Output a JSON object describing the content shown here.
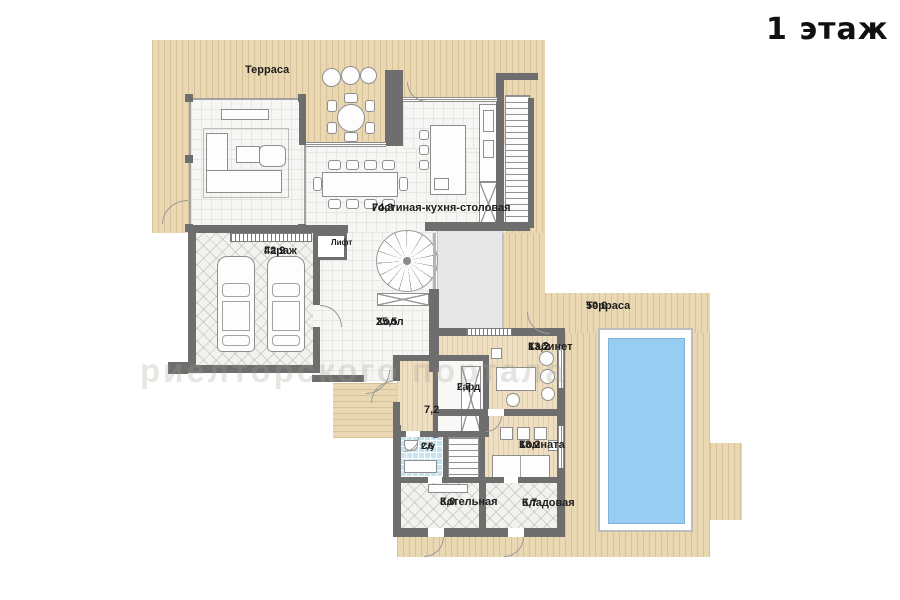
{
  "title": "1 этаж",
  "watermark": "риелторского портала",
  "colors": {
    "wall": "#6e6e6e",
    "terrace": "#ead8b3",
    "floor": "#f6f6f4",
    "wood": "#eedfc2",
    "tile": "#c5e4f0",
    "pool_water": "#98cdf2"
  },
  "rooms": {
    "terrace_top": {
      "name": "Терраса"
    },
    "living": {
      "name": "Гостиная-кухня-столовая",
      "area": "74,8"
    },
    "garage": {
      "name": "Гараж",
      "area": "42,9"
    },
    "lift": {
      "name": "Лифт"
    },
    "hall": {
      "name": "Холл",
      "area": "25,5"
    },
    "terrace_right": {
      "name": "Терраса",
      "area": "50,0"
    },
    "cabinet": {
      "name": "Кабинет",
      "area": "13,2"
    },
    "wardrobe": {
      "name": "Гард",
      "area": "2,7"
    },
    "corridor": {
      "area": "7,2"
    },
    "wc": {
      "name": "С/у",
      "area": "2,6"
    },
    "room": {
      "name": "Комната",
      "area": "18,2"
    },
    "boiler": {
      "name": "Котельная",
      "area": "8,0"
    },
    "storage": {
      "name": "Кладовая",
      "area": "6,7"
    }
  }
}
